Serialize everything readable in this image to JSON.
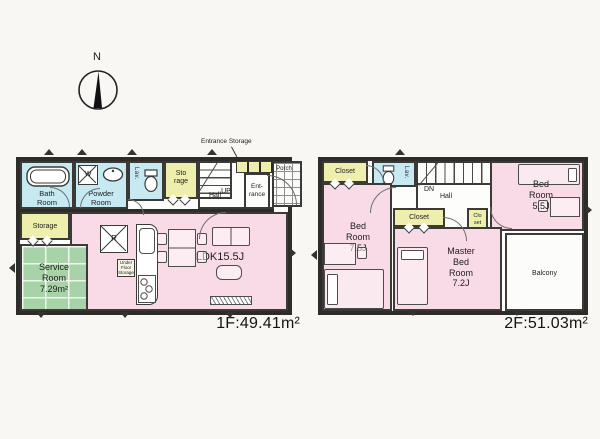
{
  "compass": {
    "north": "N"
  },
  "floor1": {
    "area_label": "1F:49.41m²",
    "entrance_storage_note": "Entrance Storage",
    "rooms": {
      "bath": "Bath\nRoom",
      "powder": "Powder\nRoom",
      "lav": "Lav.",
      "washer": "W",
      "storage_top": "Sto\nrage",
      "up": "UP",
      "hall": "Hall",
      "entrance": "Ent-\nrance",
      "porch": "Porch",
      "storage_left": "Storage",
      "service": "Service\nRoom\n7.29m²",
      "ldk": "LDK15.5J",
      "fridge": "R",
      "under_floor": "Under\nFloor\nStorage"
    }
  },
  "floor2": {
    "area_label": "2F:51.03m²",
    "rooms": {
      "closet_nw": "Closet",
      "lav": "Lav.",
      "dn": "DN",
      "hall": "Hall",
      "bed_55": "Bed\nRoom\n5.5J",
      "bed_75": "Bed\nRoom\n7.5J",
      "closet_mid": "Closet",
      "closet_small": "Clo\nset",
      "master": "Master\nBed\nRoom\n7.2J",
      "balcony": "Balcony"
    }
  },
  "colors": {
    "wall": "#2d2c29",
    "room_pink": "#f8dbe6",
    "wet_blue": "#c7e9f2",
    "storage_yellow": "#efefad",
    "service_green": "#a8d2a8",
    "background": "#f8f7f3"
  }
}
